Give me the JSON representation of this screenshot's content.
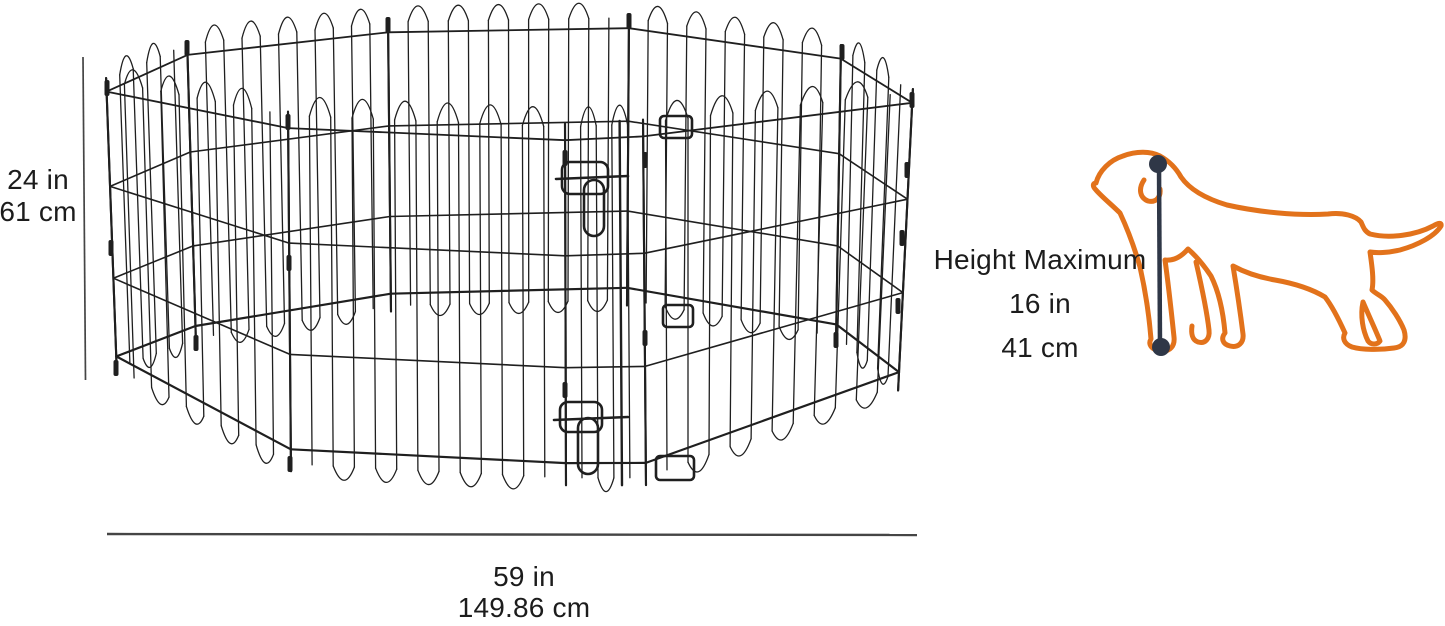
{
  "diagram_type": "product-dimensions-diagram",
  "labels": {
    "pen_height": {
      "in": "24 in",
      "cm": "61 cm"
    },
    "pen_width": {
      "in": "59 in",
      "cm": "149.86 cm"
    },
    "dog_height": {
      "title": "Height Maximum",
      "in": "16 in",
      "cm": "41 cm"
    }
  },
  "icons": {
    "pen": "octagonal-wire-exercise-pen-with-door",
    "dog": "dog-outline",
    "measure": "vertical-measure-line-with-end-dots"
  },
  "colors": {
    "background": "#ffffff",
    "wire": "#1f1f1f",
    "dimension_line": "#454545",
    "text": "#1c1c1c",
    "dog_outline": "#e2721b",
    "dog_measure": "#2f3747"
  }
}
